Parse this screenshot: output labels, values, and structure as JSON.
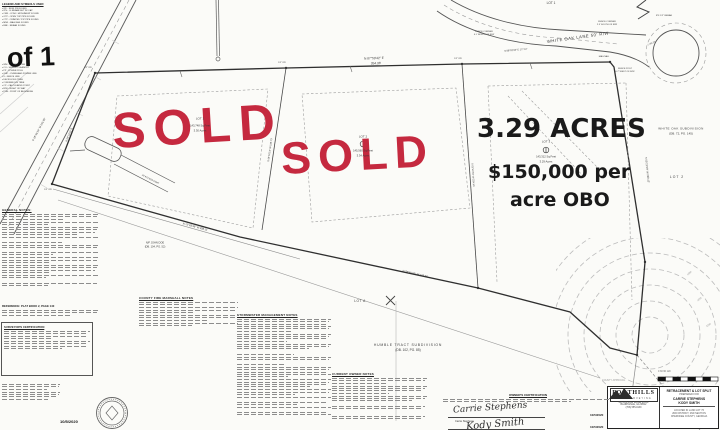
{
  "sheet_label": "of 1",
  "stamps": {
    "lot1": "SOLD",
    "lot2": "SOLD",
    "color": "#c5293f"
  },
  "listing": {
    "acreage": "3.29 ACRES",
    "price_line1": "$150,000 per",
    "price_line2": "acre OBO"
  },
  "legend": {
    "title": "LEGEND AND SYMBOLS USED",
    "items_top": [
      "IPF - IRON PIN FOUND",
      "IPS - #4 REBAR SET W/ CAP",
      "CMF - CONC. MONUMENT FOUND",
      "OTP - OPEN TOP PIPE FOUND",
      "CTP - CRIMPED TOP PIPE FOUND",
      "MNF - MAG NAIL FOUND",
      "RBF - REBAR FOUND"
    ],
    "items_bottom": [
      "WM - WATER METER",
      "CO - SEWER CLEANOUT",
      "PP - POWER POLE",
      "OHP - OVERHEAD POWER LINE",
      "X - FENCE LINE",
      "DECIDUOUS TREE",
      "CONIFEROUS TREE",
      "CP - CALCULATED POINT",
      "R/W - RIGHT OF WAY",
      "POB - POINT OF BEGINNING"
    ]
  },
  "notes": {
    "left_header": "GENERAL NOTES:",
    "reference_line": "REFERENCE: PLAT BOOK 2, PAGE 140",
    "surveyor_cert_header": "SURVEYOR'S CERTIFICATION",
    "fire_header": "COUNTY FIRE MARSHALL NOTES",
    "storm_header": "STORMWATER MANAGEMENT NOTES",
    "owner_notes_header": "CURRENT OWNER NOTES"
  },
  "certification": {
    "owner_header": "OWNER'S CERTIFICATION",
    "signature1": "Carrie Stephens",
    "signature1_printed": "Carrie Stephens",
    "signature2": "Kody Smith",
    "date1": "10/5/2020",
    "date2": "10/5/2020",
    "seal_date": "10/5/2020"
  },
  "title_block": {
    "company": "FOOTHILLS",
    "company_sub": "LAND SURVEYING",
    "address": [
      "216 ROLLING RIDGE ROAD",
      "BLAIRSVILLE, GA 30512",
      "(706) 555-0139"
    ],
    "project_type": "RETRACEMENT & LOT SPLIT",
    "prepared_for": "PREPARED FOR",
    "client1": "CARRIE STEPHENS",
    "client2": "KODY SMITH",
    "location": [
      "LOCATED IN LAND LOT 76",
      "2ND DISTRICT, 2ND SECTION",
      "CHEROKEE COUNTY, GEORGIA"
    ]
  },
  "scale_bar": {
    "ticks": "0    30    60        120",
    "approval": "COUNTY APPROVAL"
  },
  "map_labels": [
    {
      "id": "road-name-white-oak-lane",
      "t": "WHITE OAK LANE  50' R/W",
      "x": 578,
      "y": 38,
      "r": -8,
      "fs": 4.2,
      "ls": 0.5
    },
    {
      "id": "bearing-top-1",
      "t": "N 87°59'42\" E",
      "x": 374,
      "y": 59,
      "r": -2,
      "fs": 3.2
    },
    {
      "id": "bearing-top-2",
      "t": "354.38'",
      "x": 376,
      "y": 64,
      "r": -2,
      "fs": 3.2
    },
    {
      "id": "adjoiner-whiteoak-sub-1",
      "t": "WHITE OAK SUBDIVISION",
      "x": 681,
      "y": 129,
      "fs": 3,
      "ls": 0.4
    },
    {
      "id": "adjoiner-whiteoak-sub-2",
      "t": "(DB. 72, PG. 145)",
      "x": 681,
      "y": 134,
      "fs": 3
    },
    {
      "id": "adjoiner-lot2",
      "t": "LOT 2",
      "x": 677,
      "y": 178,
      "fs": 3.4,
      "ls": 1
    },
    {
      "id": "adjoiner-lot1-top",
      "t": "LOT 1",
      "x": 551,
      "y": 4,
      "fs": 3.2
    },
    {
      "id": "adjoiner-lot-a",
      "t": "LOT A",
      "x": 360,
      "y": 302,
      "fs": 3.2,
      "ls": 0.5
    },
    {
      "id": "adjoiner-humble-1",
      "t": "HUMBLE TRACT SUBDIVISION",
      "x": 408,
      "y": 346,
      "fs": 3.4,
      "ls": 0.8
    },
    {
      "id": "adjoiner-humble-2",
      "t": "(DB. 102, PG. 85)",
      "x": 408,
      "y": 351,
      "fs": 3.2
    },
    {
      "id": "adjoiner-sw-1",
      "t": "N/F  JOHN DOE",
      "x": 155,
      "y": 244,
      "fs": 2.6
    },
    {
      "id": "adjoiner-sw-2",
      "t": "(DB. 104, PG. 52)",
      "x": 155,
      "y": 248,
      "fs": 2.6
    },
    {
      "id": "fence-label-1a",
      "t": "FENCE CORNER",
      "x": 484,
      "y": 32,
      "fs": 2.2
    },
    {
      "id": "fence-label-1b",
      "t": "4.1' NORTH OF R/W",
      "x": 484,
      "y": 35,
      "fs": 2.2
    },
    {
      "id": "fence-label-2a",
      "t": "FENCE CORNER",
      "x": 607,
      "y": 22,
      "fs": 2.2
    },
    {
      "id": "fence-label-2b",
      "t": "2.3' SOUTH OF R/W",
      "x": 607,
      "y": 25,
      "fs": 2.2
    },
    {
      "id": "fence-label-3a",
      "t": "FENCE POST",
      "x": 625,
      "y": 69,
      "fs": 2.2
    },
    {
      "id": "fence-label-3b",
      "t": "0.7' WEST OF R/W",
      "x": 625,
      "y": 72,
      "fs": 2.2
    },
    {
      "id": "ipf-bulb",
      "t": "IPF 1/2\" REBAR",
      "x": 664,
      "y": 16,
      "fs": 2.2
    },
    {
      "id": "bearing-road-left",
      "t": "S 28°45'10\" W   201.80'",
      "x": 40,
      "y": 130,
      "r": -62,
      "fs": 2.6
    },
    {
      "id": "bearing-left-bnd",
      "t": "N 29°18'22\" E",
      "x": 70,
      "y": 135,
      "r": -68,
      "fs": 2.4
    },
    {
      "id": "bearing-div1",
      "t": "S 08°52'14\" W   168.70'",
      "x": 271,
      "y": 150,
      "r": -82,
      "fs": 2.4
    },
    {
      "id": "bearing-div2",
      "t": "S 03°40'55\" W   224.55'",
      "x": 472,
      "y": 175,
      "r": 86,
      "fs": 2.4
    },
    {
      "id": "bearing-right-bnd",
      "t": "S 05°21'09\" W   268.43'",
      "x": 646,
      "y": 170,
      "r": 84,
      "fs": 2.6
    },
    {
      "id": "bearing-diag-1",
      "t": "N 75°28'48\" W   208.11'",
      "x": 195,
      "y": 228,
      "r": 15,
      "fs": 2.6
    },
    {
      "id": "bearing-diag-2",
      "t": "N 76°55'40\" W   193.55'",
      "x": 415,
      "y": 275,
      "r": 13,
      "fs": 2.6
    },
    {
      "id": "bearing-road-south",
      "t": "S 88°02'33\" E   177.97'",
      "x": 516,
      "y": 51,
      "r": -5,
      "fs": 2.4
    },
    {
      "id": "curve-label",
      "t": "L=82.23'",
      "x": 652,
      "y": 44,
      "r": -22,
      "fs": 2.2
    },
    {
      "id": "access-esmt",
      "t": "30' ACCESS ESMT",
      "x": 150,
      "y": 180,
      "r": 27,
      "fs": 2.2
    },
    {
      "id": "lot3-name",
      "t": "LOT 3",
      "x": 546,
      "y": 142,
      "fs": 3
    },
    {
      "id": "lot3-sqft",
      "t": "143,312 Sq Feet",
      "x": 546,
      "y": 158,
      "fs": 2.7
    },
    {
      "id": "lot3-acres",
      "t": "3.29 Acres",
      "x": 546,
      "y": 162.5,
      "fs": 2.7
    },
    {
      "id": "lot2-name",
      "t": "LOT 2",
      "x": 363,
      "y": 137,
      "fs": 3
    },
    {
      "id": "lot2-sqft",
      "t": "145,560 Sq Feet",
      "x": 363,
      "y": 152,
      "fs": 2.7
    },
    {
      "id": "lot2-acres",
      "t": "3.34 Acres",
      "x": 363,
      "y": 156.5,
      "fs": 2.7
    },
    {
      "id": "lot1-name",
      "t": "LOT 1",
      "x": 200,
      "y": 119,
      "fs": 3
    },
    {
      "id": "lot1-sqft",
      "t": "143,748 Sq Feet",
      "x": 200,
      "y": 127,
      "fs": 2.7
    },
    {
      "id": "lot1-acres",
      "t": "3.30 Acres",
      "x": 200,
      "y": 131.5,
      "fs": 2.7
    },
    {
      "id": "pin-nw",
      "t": "1/2\" IPF",
      "x": 88,
      "y": 68,
      "fs": 2.2
    },
    {
      "id": "pin-top-1",
      "t": "1/2\" IPF",
      "x": 282,
      "y": 63,
      "fs": 2.2
    },
    {
      "id": "pin-top-2",
      "t": "1/2\" IPF",
      "x": 458,
      "y": 59,
      "fs": 2.2
    },
    {
      "id": "pin-top-3",
      "t": "MAG NAIL",
      "x": 604,
      "y": 57,
      "fs": 2.2
    },
    {
      "id": "pin-sw",
      "t": "1/2\" IPF",
      "x": 48,
      "y": 190,
      "fs": 2.2
    },
    {
      "id": "contour-1204",
      "t": "1204",
      "x": 690,
      "y": 274,
      "r": -42,
      "fs": 2.4,
      "c": "#8f8f8f"
    },
    {
      "id": "contour-1202",
      "t": "1202",
      "x": 700,
      "y": 300,
      "r": -38,
      "fs": 2.4,
      "c": "#8f8f8f"
    },
    {
      "id": "contour-1200",
      "t": "1200",
      "x": 709,
      "y": 326,
      "r": -33,
      "fs": 2.4,
      "c": "#8f8f8f"
    }
  ],
  "layout": {
    "columns": [
      {
        "id": "notes-left",
        "x": 2,
        "y": 214,
        "w": 97,
        "paras": [
          3,
          2,
          4,
          3,
          5,
          3,
          4,
          2,
          3
        ]
      },
      {
        "id": "notes-left-2",
        "x": 2,
        "y": 310,
        "w": 97,
        "paras": [
          3
        ]
      },
      {
        "id": "notes-left-3",
        "x": 2,
        "y": 384,
        "w": 58,
        "paras": [
          3,
          4
        ]
      },
      {
        "id": "notes-fire",
        "x": 139,
        "y": 302,
        "w": 99,
        "paras": [
          2,
          3,
          3,
          2
        ]
      },
      {
        "id": "notes-storm",
        "x": 237,
        "y": 319,
        "w": 94,
        "paras": [
          6,
          4,
          3,
          2,
          4,
          5,
          4,
          3,
          4,
          5
        ]
      },
      {
        "id": "notes-owner",
        "x": 332,
        "y": 378,
        "w": 95,
        "paras": [
          3,
          4,
          3,
          4,
          4
        ]
      },
      {
        "id": "owner-cert-body",
        "x": 443,
        "y": 399,
        "w": 168,
        "paras": [
          2
        ]
      }
    ],
    "cert_box_paras": [
      4,
      4
    ]
  }
}
